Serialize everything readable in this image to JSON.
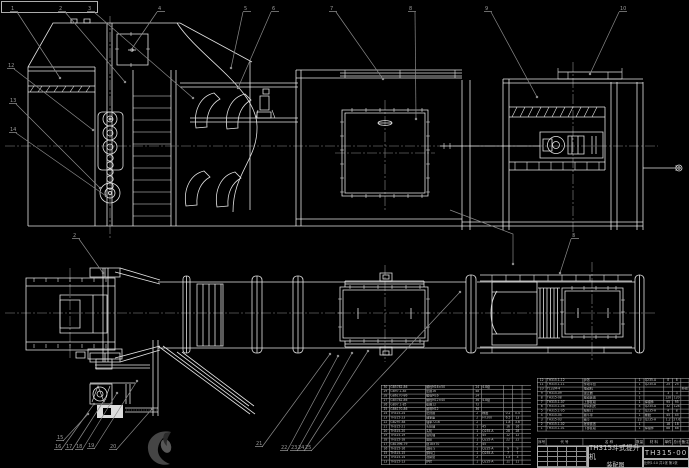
{
  "title_block": {
    "product": "TH315斗式提升机",
    "doc_type": "装配图",
    "drawing_no": "TH315-00",
    "sheet_info": "比例1:10 共1张 第1张"
  },
  "bom_right": {
    "headers": [
      "序号",
      "代  号",
      "名  称",
      "数量",
      "材  料",
      "单件",
      "总计",
      "备注"
    ],
    "rows": [
      [
        "12",
        "TH315.1-12",
        "护罩",
        "1",
        "Q235-A",
        "8",
        "8",
        ""
      ],
      [
        "11",
        "TH315.1-11",
        "传动平台",
        "1",
        "Q235-A",
        "25",
        "25",
        ""
      ],
      [
        "10",
        "Y132M-4",
        "电动机",
        "1",
        "",
        "",
        "",
        "外购"
      ],
      [
        "9",
        "TH315-09",
        "逆止器",
        "1",
        "",
        "3",
        "3",
        ""
      ],
      [
        "8",
        "TH315-08",
        "驱动装置",
        "1",
        "",
        "120",
        "120",
        ""
      ],
      [
        "7",
        "TH315.1-07",
        "上部区段",
        "1",
        "焊接件",
        "95",
        "95",
        ""
      ],
      [
        "6",
        "TH315.1-06",
        "中间机壳",
        "4",
        "Q235-A",
        "32",
        "128",
        ""
      ],
      [
        "5",
        "TH315.1-05",
        "检视门",
        "2",
        "Q235-A",
        "4",
        "8",
        ""
      ],
      [
        "4",
        "TH315-04",
        "畚斗带",
        "1",
        "橡胶",
        "45",
        "45",
        ""
      ],
      [
        "3",
        "TH315-03",
        "畚斗",
        "23",
        "Q235-A",
        "1.2",
        "27.6",
        ""
      ],
      [
        "2",
        "TH315.1-02",
        "张紧装置",
        "1",
        "",
        "18",
        "18",
        ""
      ],
      [
        "1",
        "TH315.1-01",
        "下部区段",
        "1",
        "焊接件",
        "88",
        "88",
        ""
      ]
    ]
  },
  "bom_left": {
    "rows": [
      [
        "30",
        "GB5782-86",
        "螺栓M16×50",
        "24",
        "4.8级",
        "",
        "",
        ""
      ],
      [
        "29",
        "GB97.1-85",
        "垫圈16",
        "48",
        "",
        "",
        "",
        ""
      ],
      [
        "28",
        "GB6170-86",
        "螺母M16",
        "24",
        "",
        "",
        "",
        ""
      ],
      [
        "27",
        "GB5782-86",
        "螺栓M12×40",
        "36",
        "4.8级",
        "",
        "",
        ""
      ],
      [
        "26",
        "GB97.1-85",
        "垫圈12",
        "72",
        "",
        "",
        "",
        ""
      ],
      [
        "25",
        "GB6170-86",
        "螺母M12",
        "36",
        "",
        "",
        "",
        ""
      ],
      [
        "24",
        "TH315-24",
        "密封圈",
        "2",
        "橡胶",
        "0.2",
        "0.4",
        ""
      ],
      [
        "23",
        "TH315-23",
        "轴承座",
        "2",
        "HT200",
        "6.5",
        "13",
        ""
      ],
      [
        "22",
        "GB297-84",
        "轴承7216",
        "2",
        "",
        "1.8",
        "3.6",
        ""
      ],
      [
        "21",
        "TH315-21",
        "头轮轴",
        "1",
        "45",
        "16",
        "16",
        ""
      ],
      [
        "20",
        "TH315-20",
        "头轮",
        "1",
        "Q235-A",
        "28",
        "28",
        ""
      ],
      [
        "19",
        "TH315-19",
        "底轮轴",
        "1",
        "45",
        "12",
        "12",
        ""
      ],
      [
        "18",
        "TH315-18",
        "底轮",
        "1",
        "Q235-A",
        "22",
        "22",
        ""
      ],
      [
        "17",
        "GB1096-79",
        "键18×70",
        "2",
        "45",
        "",
        "",
        ""
      ],
      [
        "16",
        "TH315-16",
        "进料斗",
        "1",
        "Q235-A",
        "9",
        "9",
        ""
      ],
      [
        "15",
        "TH315-15",
        "卸料口",
        "1",
        "Q235-A",
        "7",
        "7",
        ""
      ],
      [
        "14",
        "TH315-14",
        "观察窗",
        "2",
        "",
        "1.5",
        "3",
        ""
      ],
      [
        "13",
        "TH315-13",
        "护栏",
        "1",
        "Q235-A",
        "11",
        "11",
        ""
      ]
    ]
  },
  "balloons": [
    {
      "n": "1",
      "x": 11,
      "y": 9,
      "tx": 60,
      "ty": 78
    },
    {
      "n": "2",
      "x": 59,
      "y": 9,
      "tx": 125,
      "ty": 82
    },
    {
      "n": "3",
      "x": 88,
      "y": 9,
      "tx": 193,
      "ty": 98
    },
    {
      "n": "4",
      "x": 158,
      "y": 9,
      "tx": 131,
      "ty": 50
    },
    {
      "n": "5",
      "x": 244,
      "y": 9,
      "tx": 231,
      "ty": 68
    },
    {
      "n": "6",
      "x": 272,
      "y": 9,
      "tx": 238,
      "ty": 88
    },
    {
      "n": "7",
      "x": 330,
      "y": 9,
      "tx": 383,
      "ty": 79
    },
    {
      "n": "8",
      "x": 409,
      "y": 9,
      "tx": 416,
      "ty": 119
    },
    {
      "n": "9",
      "x": 485,
      "y": 9,
      "tx": 537,
      "ty": 97
    },
    {
      "n": "10",
      "x": 620,
      "y": 9,
      "tx": 590,
      "ty": 74
    },
    {
      "n": "12",
      "x": 8,
      "y": 66,
      "tx": 93,
      "ty": 130
    },
    {
      "n": "13",
      "x": 10,
      "y": 101,
      "tx": 100,
      "ty": 188
    },
    {
      "n": "14",
      "x": 10,
      "y": 130,
      "tx": 106,
      "ty": 196
    },
    {
      "n": "2",
      "x": 73,
      "y": 236,
      "tx": 103,
      "ty": 273
    },
    {
      "n": "3",
      "x": 572,
      "y": 236,
      "tx": 560,
      "ty": 273
    },
    {
      "n": "15",
      "x": 57,
      "y": 438,
      "tx": 88,
      "ty": 414
    },
    {
      "n": "16",
      "x": 55,
      "y": 447,
      "tx": 94,
      "ty": 404
    },
    {
      "n": "17",
      "x": 66,
      "y": 447,
      "tx": 105,
      "ty": 399
    },
    {
      "n": "18",
      "x": 76,
      "y": 447,
      "tx": 117,
      "ty": 393
    },
    {
      "n": "19",
      "x": 88,
      "y": 446,
      "tx": 137,
      "ty": 381
    },
    {
      "n": "20",
      "x": 110,
      "y": 447,
      "tx": 152,
      "ty": 409
    },
    {
      "n": "21",
      "x": 256,
      "y": 444,
      "tx": 330,
      "ty": 354
    },
    {
      "n": "22",
      "x": 281,
      "y": 448,
      "tx": 338,
      "ty": 356
    },
    {
      "n": "23",
      "x": 291,
      "y": 448,
      "tx": 352,
      "ty": 353
    },
    {
      "n": "24",
      "x": 298,
      "y": 448,
      "tx": 368,
      "ty": 351
    },
    {
      "n": "25",
      "x": 305,
      "y": 448,
      "tx": 460,
      "ty": 292
    }
  ],
  "colors": {
    "background": "#000000",
    "line": "#e3e3e3",
    "leader": "#8a8a8a",
    "centerline": "#8d8d8d",
    "watermark": "#454545"
  }
}
